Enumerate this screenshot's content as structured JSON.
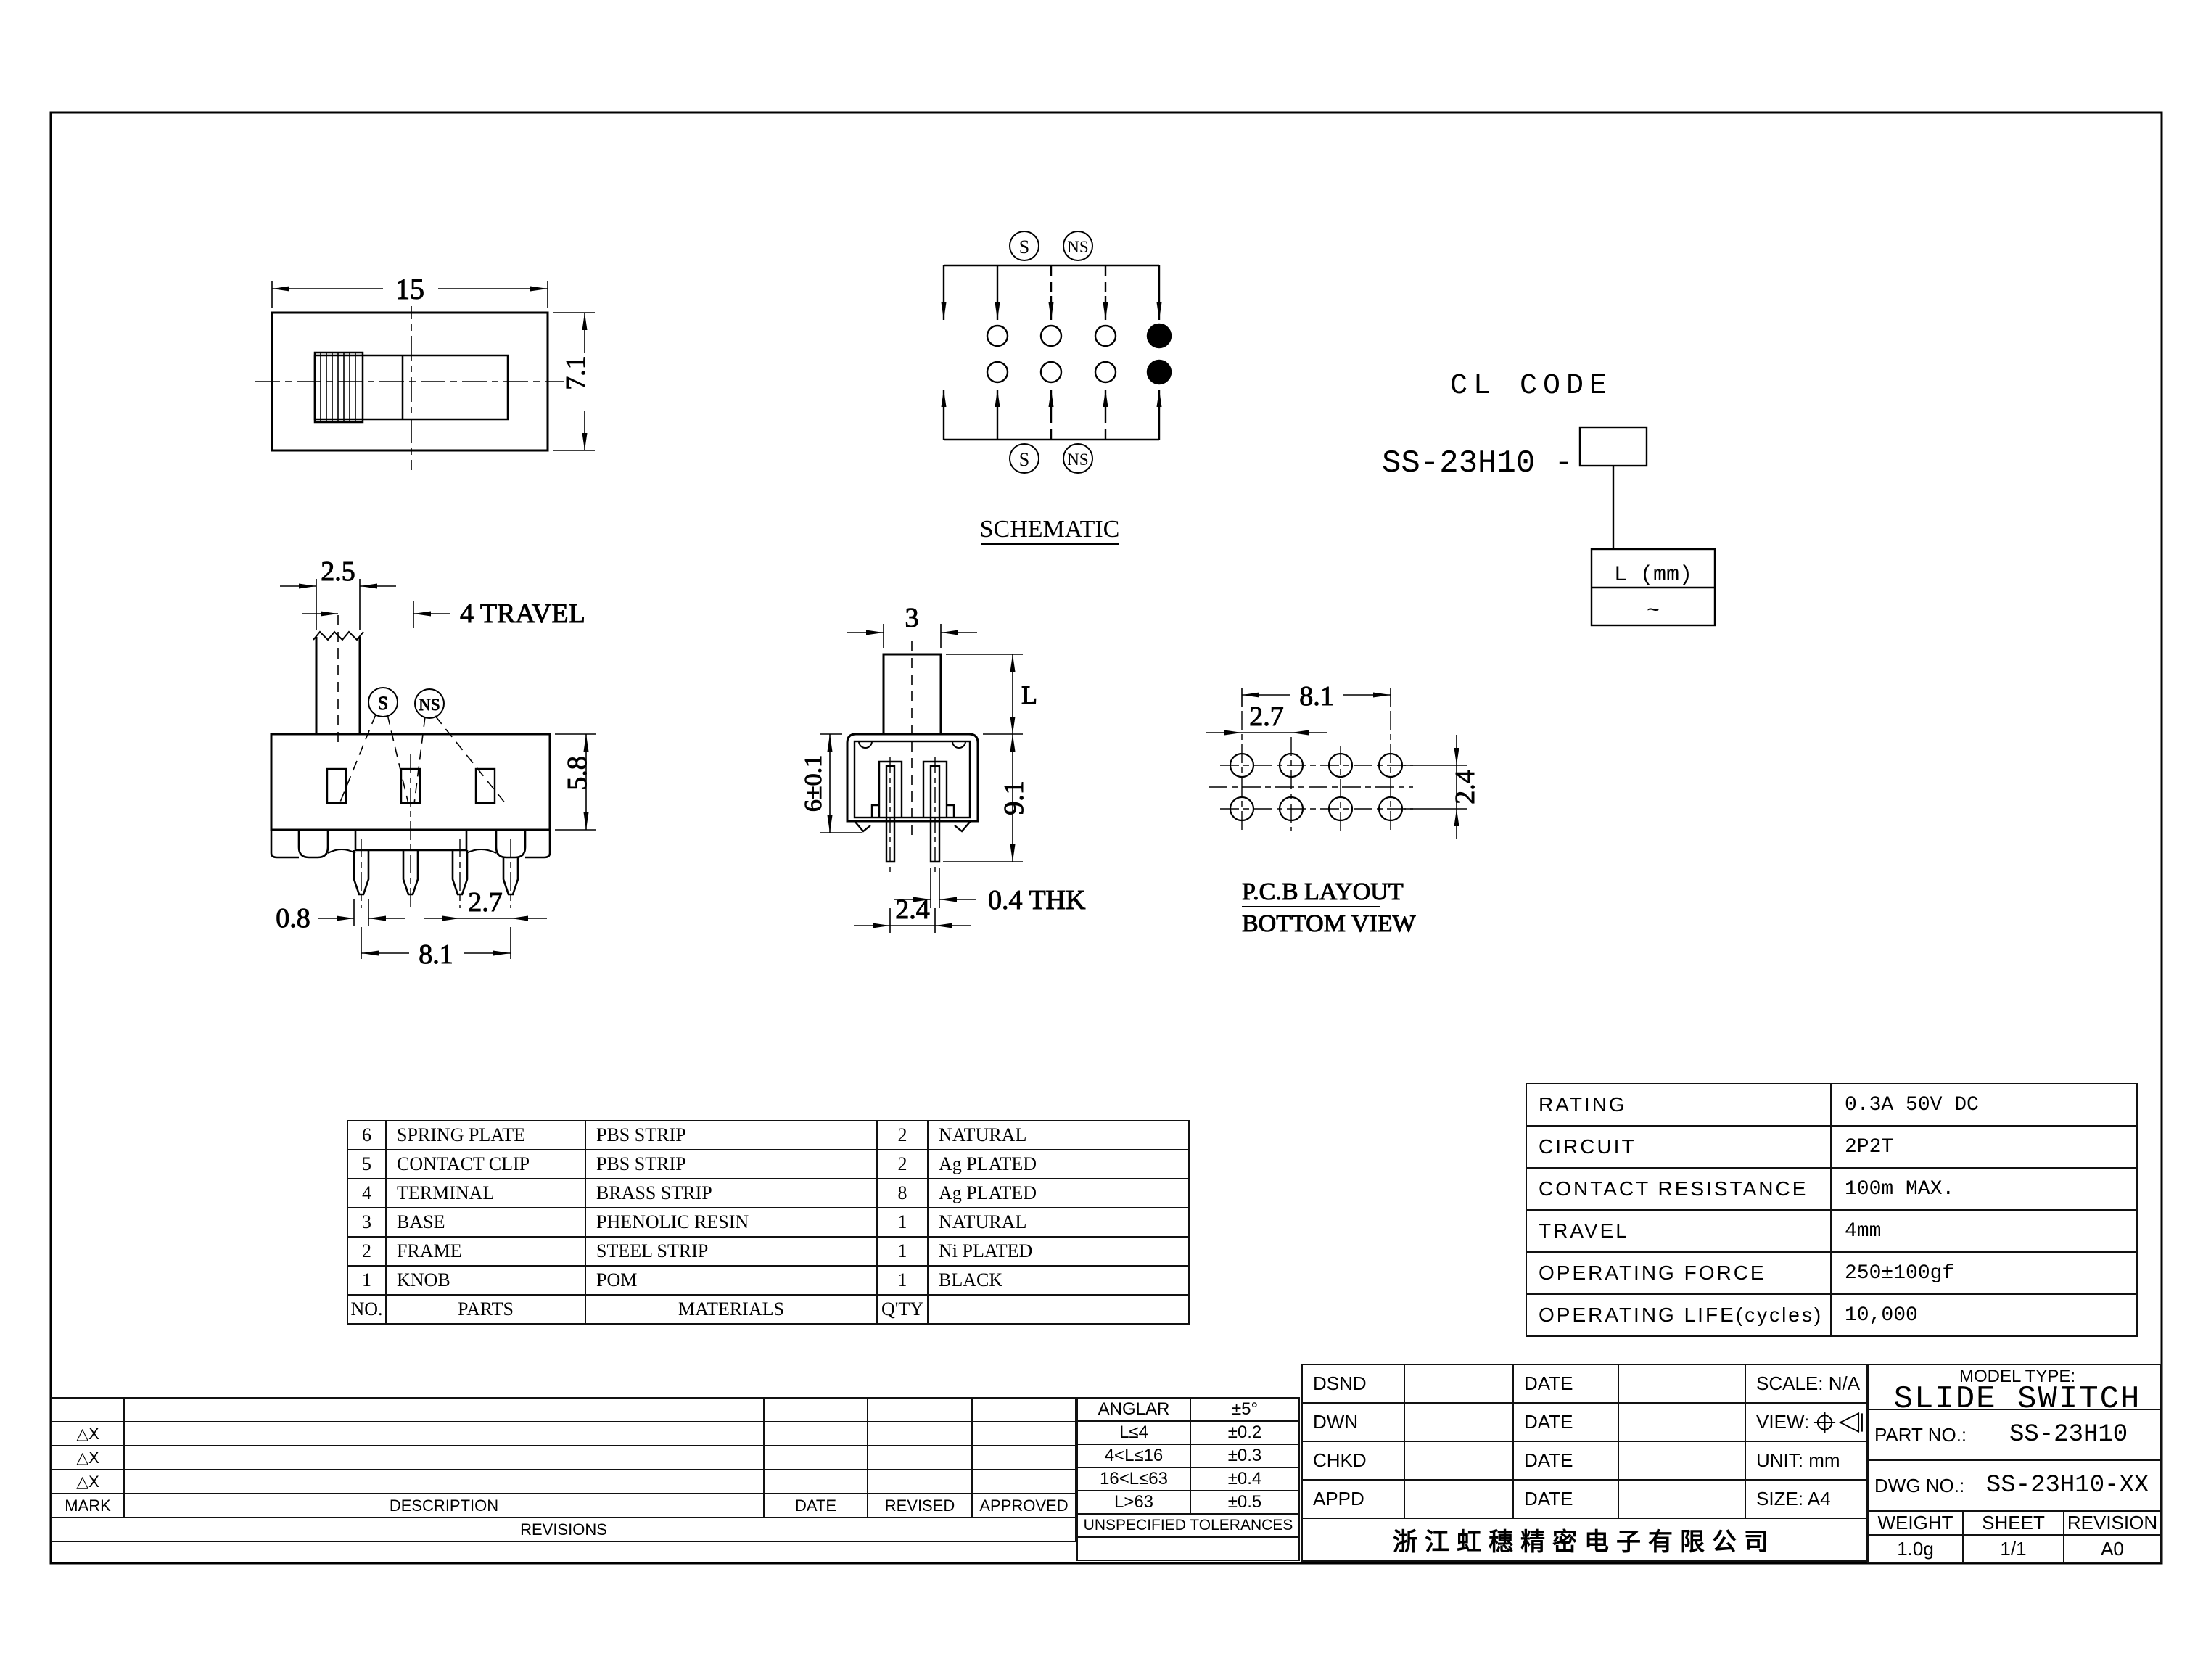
{
  "views": {
    "top": {
      "dim_width": "15",
      "dim_height": "7.1"
    },
    "schematic": {
      "s": "S",
      "ns": "NS",
      "title": "SCHEMATIC"
    },
    "cl_code": {
      "title": "CL CODE",
      "prefix": "SS-23H10 -",
      "l_mm": "L (mm)",
      "range": "~"
    },
    "front": {
      "dim_knob": "2.5",
      "dim_travel": "4 TRAVEL",
      "s": "S",
      "ns": "NS",
      "dim_height": "5.8",
      "dim_pin_w": "0.8",
      "dim_pitch": "2.7",
      "dim_span": "8.1"
    },
    "side": {
      "dim_knob": "3",
      "dim_l": "L",
      "dim_total": "9.1",
      "dim_body": "6±0.1",
      "dim_thk": "0.4 THK",
      "dim_pitch": "2.4"
    },
    "pcb": {
      "dim_span": "8.1",
      "dim_pitch": "2.7",
      "dim_rows": "2.4",
      "title": "P.C.B LAYOUT",
      "subtitle": "BOTTOM VIEW"
    }
  },
  "parts_table": {
    "header": {
      "no": "NO.",
      "parts": "PARTS",
      "materials": "MATERIALS",
      "qty": "Q'TY",
      "finish": ""
    },
    "rows": [
      {
        "no": "6",
        "part": "SPRING PLATE",
        "material": "PBS STRIP",
        "qty": "2",
        "finish": "NATURAL"
      },
      {
        "no": "5",
        "part": "CONTACT CLIP",
        "material": "PBS STRIP",
        "qty": "2",
        "finish": "Ag PLATED"
      },
      {
        "no": "4",
        "part": "TERMINAL",
        "material": "BRASS STRIP",
        "qty": "8",
        "finish": "Ag PLATED"
      },
      {
        "no": "3",
        "part": "BASE",
        "material": "PHENOLIC RESIN",
        "qty": "1",
        "finish": "NATURAL"
      },
      {
        "no": "2",
        "part": "FRAME",
        "material": "STEEL STRIP",
        "qty": "1",
        "finish": "Ni PLATED"
      },
      {
        "no": "1",
        "part": "KNOB",
        "material": "POM",
        "qty": "1",
        "finish": "BLACK"
      }
    ]
  },
  "spec_table": {
    "rows": [
      {
        "label": "RATING",
        "value": "0.3A 50V DC"
      },
      {
        "label": "CIRCUIT",
        "value": "2P2T"
      },
      {
        "label": "CONTACT RESISTANCE",
        "value": "100m  MAX."
      },
      {
        "label": "TRAVEL",
        "value": "4mm"
      },
      {
        "label": "OPERATING FORCE",
        "value": "250±100gf"
      },
      {
        "label": "OPERATING LIFE(cycles)",
        "value": "10,000"
      }
    ]
  },
  "revisions": {
    "mark": "△X",
    "headers": {
      "mark": "MARK",
      "description": "DESCRIPTION",
      "date": "DATE",
      "revised": "REVISED",
      "approved": "APPROVED"
    },
    "title": "REVISIONS"
  },
  "tolerances": {
    "title": "UNSPECIFIED TOLERANCES",
    "rows": [
      {
        "range": "ANGLAR",
        "tol": "±5°"
      },
      {
        "range": "L≤4",
        "tol": "±0.2"
      },
      {
        "range": "4<L≤16",
        "tol": "±0.3"
      },
      {
        "range": "16<L≤63",
        "tol": "±0.4"
      },
      {
        "range": "L>63",
        "tol": "±0.5"
      }
    ]
  },
  "title_block": {
    "approvals": [
      {
        "label": "DSND",
        "date": "DATE",
        "info": "SCALE: N/A"
      },
      {
        "label": "DWN",
        "date": "DATE",
        "info": "VIEW:"
      },
      {
        "label": "CHKD",
        "date": "DATE",
        "info": "UNIT: mm"
      },
      {
        "label": "APPD",
        "date": "DATE",
        "info": "SIZE: A4"
      }
    ],
    "company": "浙江虹穗精密电子有限公司",
    "model_type_label": "MODEL TYPE:",
    "model_type": "SLIDE SWITCH",
    "part_no_label": "PART NO.:",
    "part_no": "SS-23H10",
    "dwg_no_label": "DWG NO.:",
    "dwg_no": "SS-23H10-XX",
    "weight_label": "WEIGHT",
    "weight": "1.0g",
    "sheet_label": "SHEET",
    "sheet": "1/1",
    "revision_label": "REVISION",
    "revision": "A0"
  }
}
